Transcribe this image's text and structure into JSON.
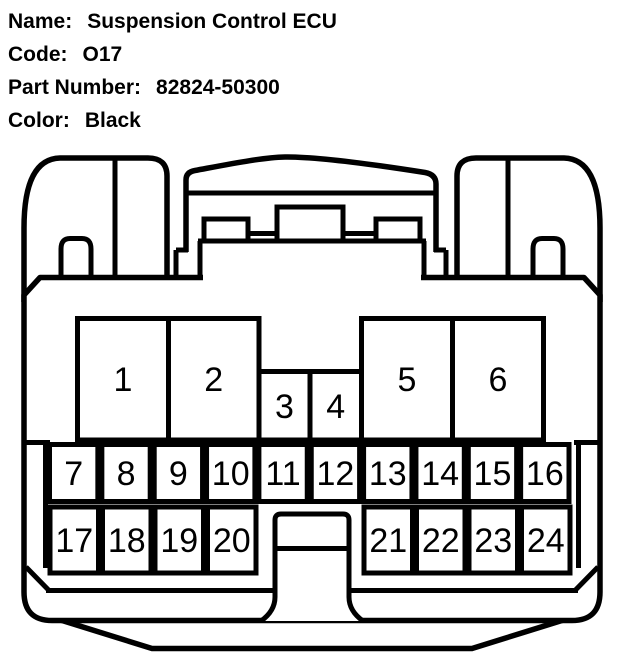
{
  "header": {
    "rows": [
      {
        "label": "Name:",
        "value": "Suspension Control ECU"
      },
      {
        "label": "Code:",
        "value": "O17"
      },
      {
        "label": "Part Number:",
        "value": "82824-50300"
      },
      {
        "label": "Color:",
        "value": "Black"
      }
    ]
  },
  "connector": {
    "description": "24-pin connector face diagram",
    "colors": {
      "line": "#000000",
      "fill": "#ffffff"
    },
    "pins": {
      "top_row_large_left": [
        "1",
        "2"
      ],
      "top_row_small": [
        "3",
        "4"
      ],
      "top_row_large_right": [
        "5",
        "6"
      ],
      "middle_row": [
        "7",
        "8",
        "9",
        "10",
        "11",
        "12",
        "13",
        "14",
        "15",
        "16"
      ],
      "bottom_row_left": [
        "17",
        "18",
        "19",
        "20"
      ],
      "bottom_row_right": [
        "21",
        "22",
        "23",
        "24"
      ]
    }
  }
}
